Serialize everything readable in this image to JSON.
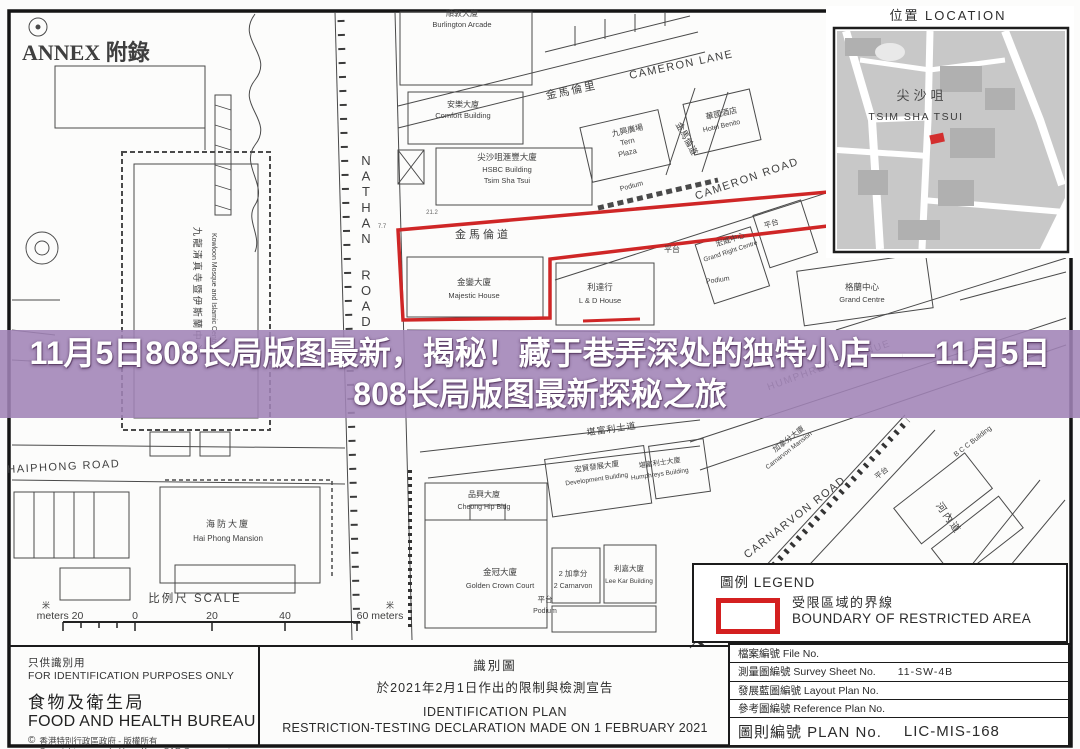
{
  "banner": {
    "title": "11月5日808长局版图最新，揭秘！藏于巷弄深处的独特小店——11月5日808长局版图最新探秘之旅",
    "bg": "rgba(160,131,182,0.88)"
  },
  "inset": {
    "marker_color": "#d32f2f"
  },
  "legend": {
    "heading": "圖例 LEGEND",
    "item_zh": "受限區域的界線",
    "item_en": "BOUNDARY OF RESTRICTED AREA",
    "boundary_color": "#d42020"
  },
  "footer": {
    "left": {
      "line1_zh": "只供識別用",
      "line1_en": "FOR IDENTIFICATION PURPOSES ONLY",
      "org_zh": "食物及衛生局",
      "org_en": "FOOD AND HEALTH BUREAU",
      "copy_sym": "©",
      "copyright_zh": "香港特別行政區政府 - 版權所有",
      "copyright_en": "Copyright reserved - Hong Kong SAR Government"
    },
    "middle": {
      "title_zh": "識別圖",
      "subtitle_zh": "於2021年2月1日作出的限制與檢測宣告",
      "title_en": "IDENTIFICATION PLAN",
      "subtitle_en": "RESTRICTION-TESTING DECLARATION MADE ON 1 FEBRUARY 2021"
    },
    "table": {
      "rows": [
        {
          "label": "檔案編號 File No.",
          "value": ""
        },
        {
          "label": "測量圖編號 Survey Sheet No.",
          "value": "11-SW-4B"
        },
        {
          "label": "發展藍圖編號 Layout Plan No.",
          "value": ""
        },
        {
          "label": "參考圖編號 Reference Plan No.",
          "value": ""
        },
        {
          "label": "圖則編號 PLAN No.",
          "value": "LIC-MIS-168"
        }
      ]
    }
  },
  "map": {
    "boundary_color": "#cf2626",
    "labels": [
      {
        "t": "ANNEX 附錄",
        "x": 22,
        "y": 60,
        "s": 22,
        "a": "start",
        "b": true,
        "f": "\"Liberation Serif\",\"DejaVu Serif\",serif"
      },
      {
        "t": "位置 LOCATION",
        "x": 948,
        "y": 20,
        "s": 13,
        "ls": 2,
        "c": "#2e2e2e"
      },
      {
        "t": "尖沙咀",
        "x": 922,
        "y": 100,
        "s": 13,
        "c": "#4a4a4a",
        "ls": 4
      },
      {
        "t": "TSIM SHA TSUI",
        "x": 916,
        "y": 120,
        "s": 10.5,
        "c": "#3a3a3a",
        "ls": 1.5
      },
      {
        "t": "NATHAN ROAD",
        "x": 366,
        "y": 165,
        "s": 13,
        "vert": true
      },
      {
        "t": "HAIPHONG ROAD",
        "x": 64,
        "y": 470,
        "s": 11,
        "r": -3,
        "ls": 1.5
      },
      {
        "t": "CAMERON LANE",
        "x": 682,
        "y": 68,
        "s": 11,
        "r": -12,
        "ls": 1.5
      },
      {
        "t": "金馬倫里",
        "x": 572,
        "y": 94,
        "s": 11,
        "r": -12,
        "ls": 2
      },
      {
        "t": "CAMERON ROAD",
        "x": 748,
        "y": 182,
        "s": 11,
        "r": -19,
        "ls": 1.5
      },
      {
        "t": "金馬倫道",
        "x": 483,
        "y": 238,
        "s": 11,
        "ls": 3
      },
      {
        "t": "金馬倫道",
        "x": 684,
        "y": 140,
        "s": 9,
        "r": 62
      },
      {
        "t": "CARNARVON ROAD",
        "x": 797,
        "y": 520,
        "s": 11,
        "r": -38,
        "ls": 1.5
      },
      {
        "t": "堪富利士道",
        "x": 612,
        "y": 432,
        "s": 9,
        "r": -8,
        "ls": 1
      },
      {
        "t": "河內道",
        "x": 946,
        "y": 520,
        "s": 10,
        "r": 55,
        "ls": 2
      },
      {
        "t": "HUMPHREYS AVENUE",
        "x": 830,
        "y": 368,
        "s": 10,
        "r": -20,
        "ls": 1.5,
        "c": "#6b6b6b"
      },
      {
        "t": "順敦大廈",
        "x": 462,
        "y": 16,
        "s": 8
      },
      {
        "t": "Burlington Arcade",
        "x": 462,
        "y": 27,
        "s": 7.5
      },
      {
        "t": "安樂大廈",
        "x": 463,
        "y": 107,
        "s": 8
      },
      {
        "t": "Comfort Building",
        "x": 463,
        "y": 118,
        "s": 7.5
      },
      {
        "t": "尖沙咀滙豐大廈",
        "x": 507,
        "y": 160,
        "s": 8.5
      },
      {
        "t": "HSBC Building",
        "x": 507,
        "y": 172,
        "s": 7.5
      },
      {
        "t": "Tsim Sha Tsui",
        "x": 507,
        "y": 183,
        "s": 7.5
      },
      {
        "t": "九興廣場",
        "x": 628,
        "y": 133,
        "s": 8,
        "r": -13
      },
      {
        "t": "Tern",
        "x": 628,
        "y": 144,
        "s": 7.5,
        "r": -13
      },
      {
        "t": "Plaza",
        "x": 628,
        "y": 155,
        "s": 7.5,
        "r": -13
      },
      {
        "t": "華國酒店",
        "x": 722,
        "y": 116,
        "s": 8,
        "r": -13
      },
      {
        "t": "Hotel Benito",
        "x": 722,
        "y": 128,
        "s": 7,
        "r": -13
      },
      {
        "t": "Podium",
        "x": 632,
        "y": 188,
        "s": 7,
        "r": -15
      },
      {
        "t": "平台",
        "x": 672,
        "y": 252,
        "s": 8
      },
      {
        "t": "金鑾大廈",
        "x": 474,
        "y": 285,
        "s": 8.5
      },
      {
        "t": "Majestic House",
        "x": 474,
        "y": 298,
        "s": 7.5
      },
      {
        "t": "利達行",
        "x": 600,
        "y": 290,
        "s": 8.5
      },
      {
        "t": "L & D House",
        "x": 600,
        "y": 303,
        "s": 7.5
      },
      {
        "t": "宏威中心",
        "x": 731,
        "y": 242,
        "s": 7.5,
        "r": -18
      },
      {
        "t": "Grand Right Centre",
        "x": 731,
        "y": 253,
        "s": 6.5,
        "r": -18
      },
      {
        "t": "平台",
        "x": 772,
        "y": 226,
        "s": 7.5,
        "r": -18
      },
      {
        "t": "格蘭中心",
        "x": 862,
        "y": 290,
        "s": 8.5
      },
      {
        "t": "Grand Centre",
        "x": 862,
        "y": 302,
        "s": 7.5
      },
      {
        "t": "Podium",
        "x": 718,
        "y": 282,
        "s": 7,
        "r": -8
      },
      {
        "t": "九龍清真寺暨伊斯蘭中心",
        "x": 194,
        "y": 290,
        "s": 9.5,
        "r": 90,
        "ls": 2
      },
      {
        "t": "Kowloon Mosque and Islamic Centre",
        "x": 212,
        "y": 290,
        "s": 7,
        "r": 90
      },
      {
        "t": "海防大廈",
        "x": 228,
        "y": 527,
        "s": 9,
        "ls": 2
      },
      {
        "t": "Hai Phong Mansion",
        "x": 228,
        "y": 541,
        "s": 8
      },
      {
        "t": "品興大廈",
        "x": 484,
        "y": 497,
        "s": 8
      },
      {
        "t": "Cheong Hip Bldg",
        "x": 484,
        "y": 509,
        "s": 7
      },
      {
        "t": "金冠大廈",
        "x": 500,
        "y": 575,
        "s": 8.5
      },
      {
        "t": "Golden Crown Court",
        "x": 500,
        "y": 588,
        "s": 7.5
      },
      {
        "t": "2 加拿分",
        "x": 573,
        "y": 576,
        "s": 7.5
      },
      {
        "t": "2 Carnarvon",
        "x": 573,
        "y": 588,
        "s": 7
      },
      {
        "t": "利嘉大廈",
        "x": 629,
        "y": 571,
        "s": 7.5
      },
      {
        "t": "Lee Kar Building",
        "x": 629,
        "y": 583,
        "s": 6.5
      },
      {
        "t": "宏貿發展大廈",
        "x": 597,
        "y": 469,
        "s": 7.5,
        "r": -8
      },
      {
        "t": "Development Building",
        "x": 597,
        "y": 481,
        "s": 6.5,
        "r": -8
      },
      {
        "t": "堪富利士大廈",
        "x": 660,
        "y": 465,
        "s": 7,
        "r": -8
      },
      {
        "t": "Humphreys Building",
        "x": 660,
        "y": 476,
        "s": 6.5,
        "r": -8
      },
      {
        "t": "加拿分大廈",
        "x": 790,
        "y": 441,
        "s": 7.5,
        "r": -38
      },
      {
        "t": "Carnarvon Mansion",
        "x": 790,
        "y": 452,
        "s": 6.5,
        "r": -38
      },
      {
        "t": "B C C Building",
        "x": 974,
        "y": 443,
        "s": 7,
        "r": -38
      },
      {
        "t": "平台",
        "x": 545,
        "y": 602,
        "s": 7.5
      },
      {
        "t": "Podium",
        "x": 545,
        "y": 613,
        "s": 7
      },
      {
        "t": "平台",
        "x": 883,
        "y": 475,
        "s": 7.5,
        "r": -38
      },
      {
        "t": "21.2",
        "x": 432,
        "y": 214,
        "s": 6,
        "c": "#666"
      },
      {
        "t": "7.7",
        "x": 382,
        "y": 228,
        "s": 6,
        "c": "#666"
      },
      {
        "t": "比例尺 SCALE",
        "x": 195,
        "y": 602,
        "s": 11.5,
        "ls": 2
      },
      {
        "t": "米",
        "x": 46,
        "y": 608,
        "s": 8
      },
      {
        "t": "meters 20",
        "x": 60,
        "y": 619,
        "s": 10.5
      },
      {
        "t": "0",
        "x": 135,
        "y": 619,
        "s": 10.5
      },
      {
        "t": "20",
        "x": 212,
        "y": 619,
        "s": 10.5
      },
      {
        "t": "40",
        "x": 285,
        "y": 619,
        "s": 10.5
      },
      {
        "t": "60 meters",
        "x": 380,
        "y": 619,
        "s": 10.5
      },
      {
        "t": "米",
        "x": 390,
        "y": 608,
        "s": 8
      }
    ]
  }
}
